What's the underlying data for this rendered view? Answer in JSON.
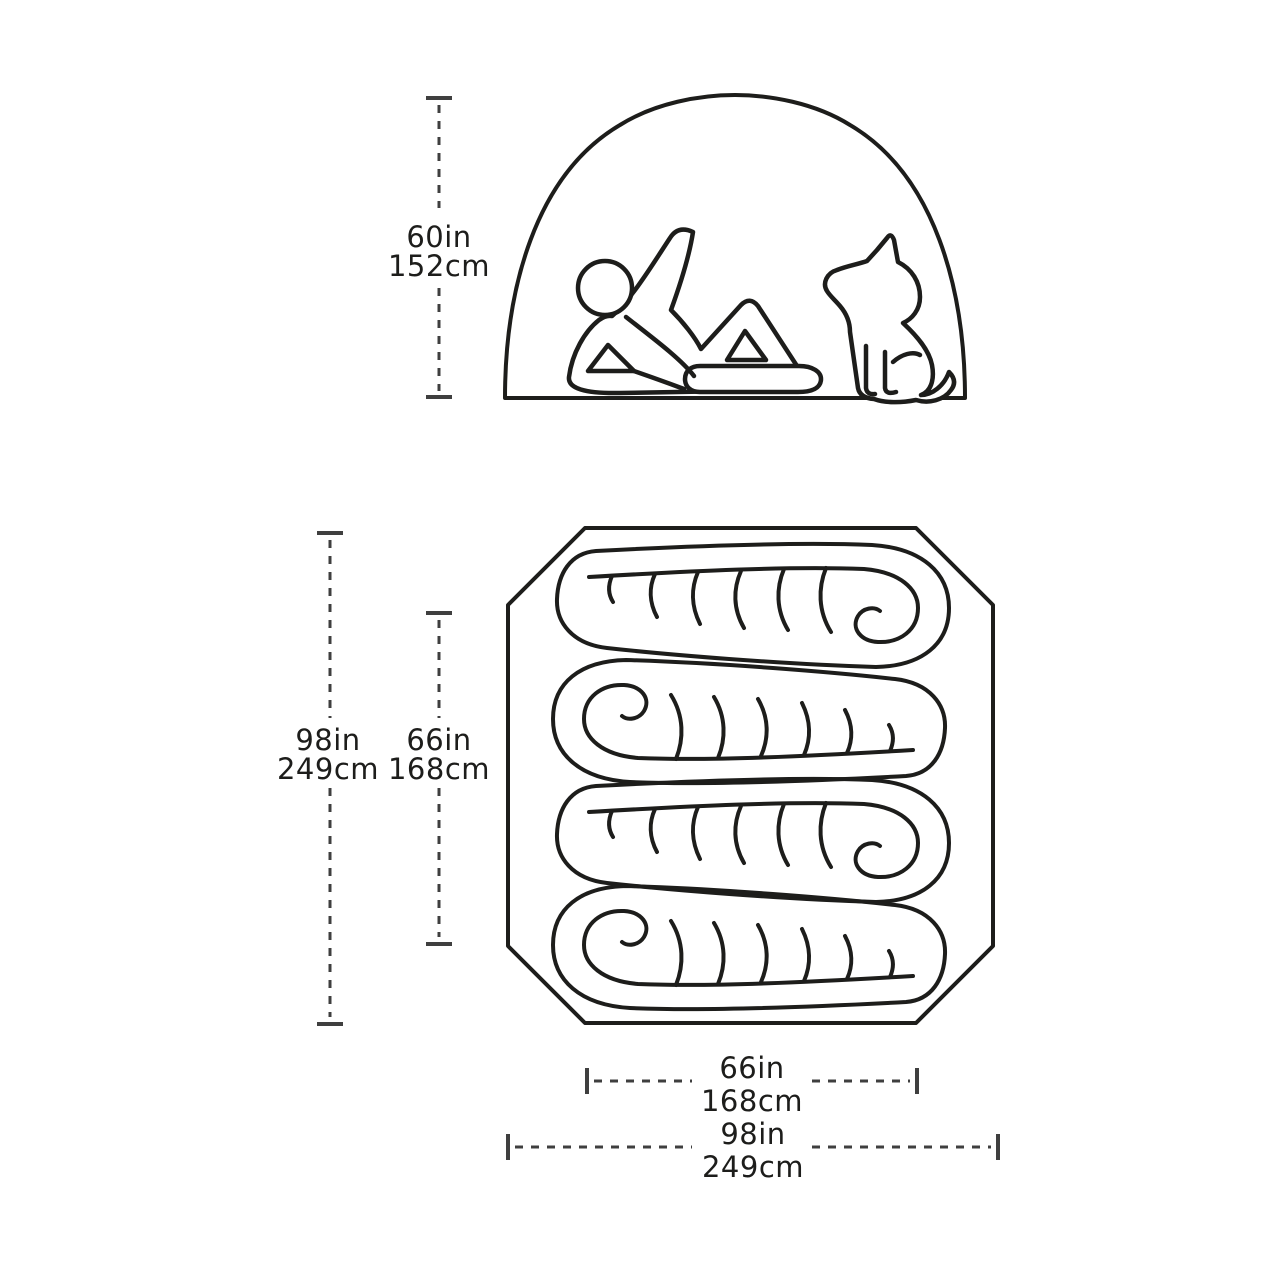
{
  "diagram": {
    "type": "tent-specification-diagram",
    "side_view": {
      "description": "Tent side profile with reclining person and sitting dog",
      "peak_height": {
        "in": "60in",
        "cm": "152cm"
      }
    },
    "floor_plan": {
      "description": "Tent floor plan with four sleeping bags",
      "sleeping_bag_count": 4,
      "floor_length": {
        "in": "98in",
        "cm": "249cm"
      },
      "inner_length": {
        "in": "66in",
        "cm": "168cm"
      },
      "inner_width": {
        "in": "66in",
        "cm": "168cm"
      },
      "floor_width": {
        "in": "98in",
        "cm": "249cm"
      }
    },
    "colors": {
      "outline": "#1d1d1b",
      "dimension_line": "#3f3f3f",
      "label_text": "#1d1d1b",
      "background": "#ffffff"
    }
  }
}
